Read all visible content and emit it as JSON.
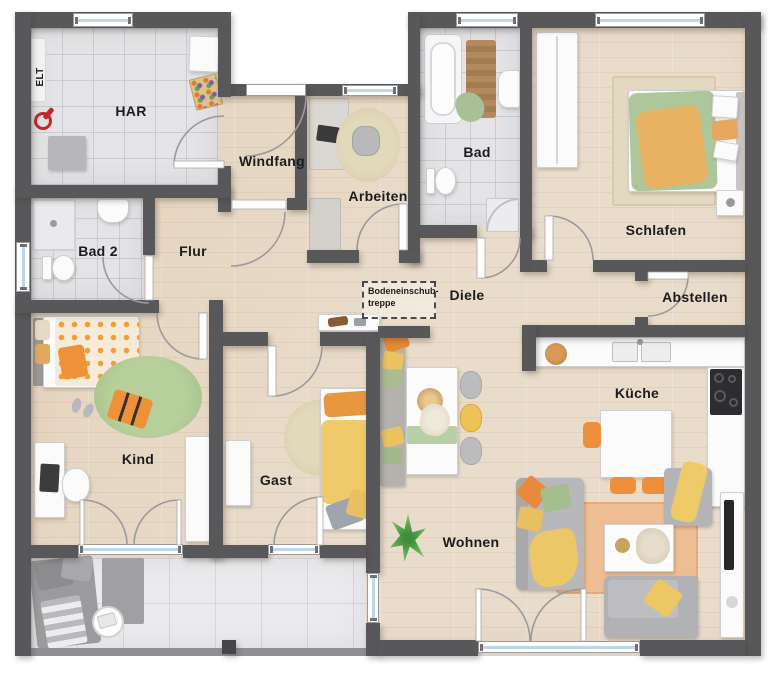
{
  "plan": {
    "type": "floor-plan",
    "rooms": [
      {
        "id": "elt",
        "label": "ELT"
      },
      {
        "id": "har",
        "label": "HAR"
      },
      {
        "id": "windfang",
        "label": "Windfang"
      },
      {
        "id": "arbeiten",
        "label": "Arbeiten"
      },
      {
        "id": "bad",
        "label": "Bad"
      },
      {
        "id": "schlafen",
        "label": "Schlafen"
      },
      {
        "id": "bad2",
        "label": "Bad 2"
      },
      {
        "id": "flur",
        "label": "Flur"
      },
      {
        "id": "diele",
        "label": "Diele"
      },
      {
        "id": "abstellen",
        "label": "Abstellen"
      },
      {
        "id": "kind",
        "label": "Kind"
      },
      {
        "id": "gast",
        "label": "Gast"
      },
      {
        "id": "kueche",
        "label": "Küche"
      },
      {
        "id": "wohnen",
        "label": "Wohnen"
      }
    ],
    "annotation": {
      "line1": "Bodeneinschub-",
      "line2": "treppe"
    },
    "colors": {
      "wall": "#58585a",
      "wood_floor": "#e9dccb",
      "tile_floor": "#e4e4e6",
      "terrace_floor": "#ebebed",
      "window_glass": "#bed7e6",
      "accent_orange": "#ee9139",
      "accent_yellow": "#ecc25e",
      "accent_green": "#a9c295",
      "furniture_gray": "#b7b7b9"
    }
  }
}
